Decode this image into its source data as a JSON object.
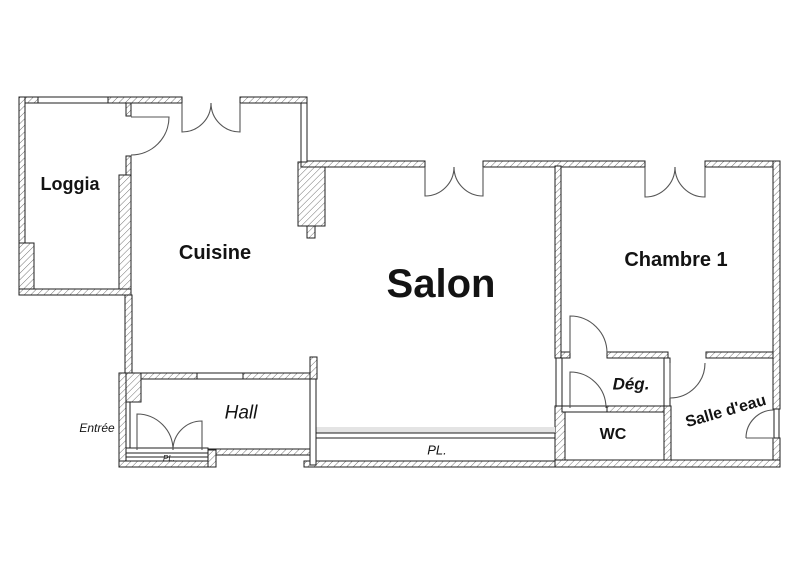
{
  "page": {
    "type": "apartment floor plan drawing"
  },
  "rooms": {
    "loggia": {
      "label": "Loggia"
    },
    "cuisine": {
      "label": "Cuisine"
    },
    "salon": {
      "label": "Salon"
    },
    "chambre1": {
      "label": "Chambre 1"
    },
    "hall": {
      "label": "Hall"
    },
    "entree": {
      "label": "Entrée"
    },
    "degagement": {
      "label": "Dég."
    },
    "wc": {
      "label": "WC"
    },
    "salle_deau": {
      "label": "Salle d'eau"
    },
    "placard_salon": {
      "label": "PL."
    },
    "placard_hall": {
      "label": "PL."
    }
  },
  "colors": {
    "background": "#ffffff",
    "wall_outline": "#1f1f1f",
    "hatch_line": "#6a6a6a",
    "door_arc": "#555555",
    "text": "#131313",
    "shadow_band": "#e4e4e4"
  }
}
